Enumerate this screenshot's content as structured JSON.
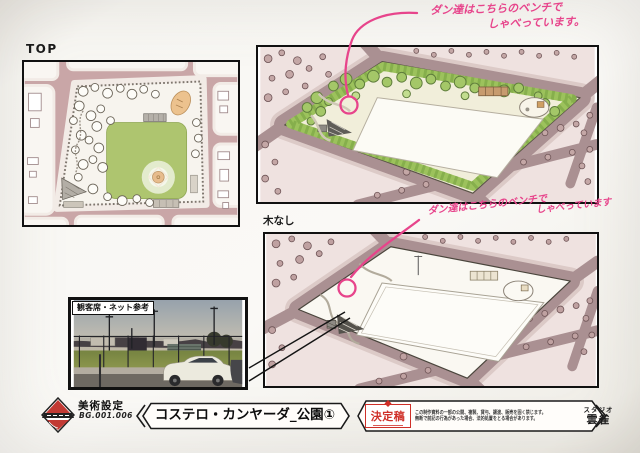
{
  "labels": {
    "top_view": "TOP",
    "no_trees": "木なし"
  },
  "photo": {
    "caption": "観客席・ネット参考"
  },
  "notes": {
    "ink_color": "#e7448b",
    "note1": {
      "line1": "ダン達はこちらのベンチで",
      "line2": "しゃべっています。"
    },
    "note2": {
      "line1": "ダン達はこちらのベンチで",
      "line2": "しゃべっています"
    }
  },
  "footer": {
    "department": "美術設定",
    "board_number": "BG.001.006",
    "title": "コステロ・カンヤーダ_公園①",
    "approval_stamp": "決定稿",
    "disclaimer_line1": "この制作資料の一部の公開、複製、貸与、譲渡、販売を固く禁じます。",
    "disclaimer_line2": "無断で前記の行為があった場合、法的処置をとる場合があります。",
    "studio_prefix": "スタジオ",
    "studio_name": "雲雀"
  },
  "colors": {
    "street_mauve": "#aa9092",
    "field_green": "#aec56f",
    "hedge_green": "#9cc25c",
    "stamp_red": "#cf2f28",
    "studio_green": "#2e8b3a",
    "annotation_pink": "#e7448b"
  }
}
